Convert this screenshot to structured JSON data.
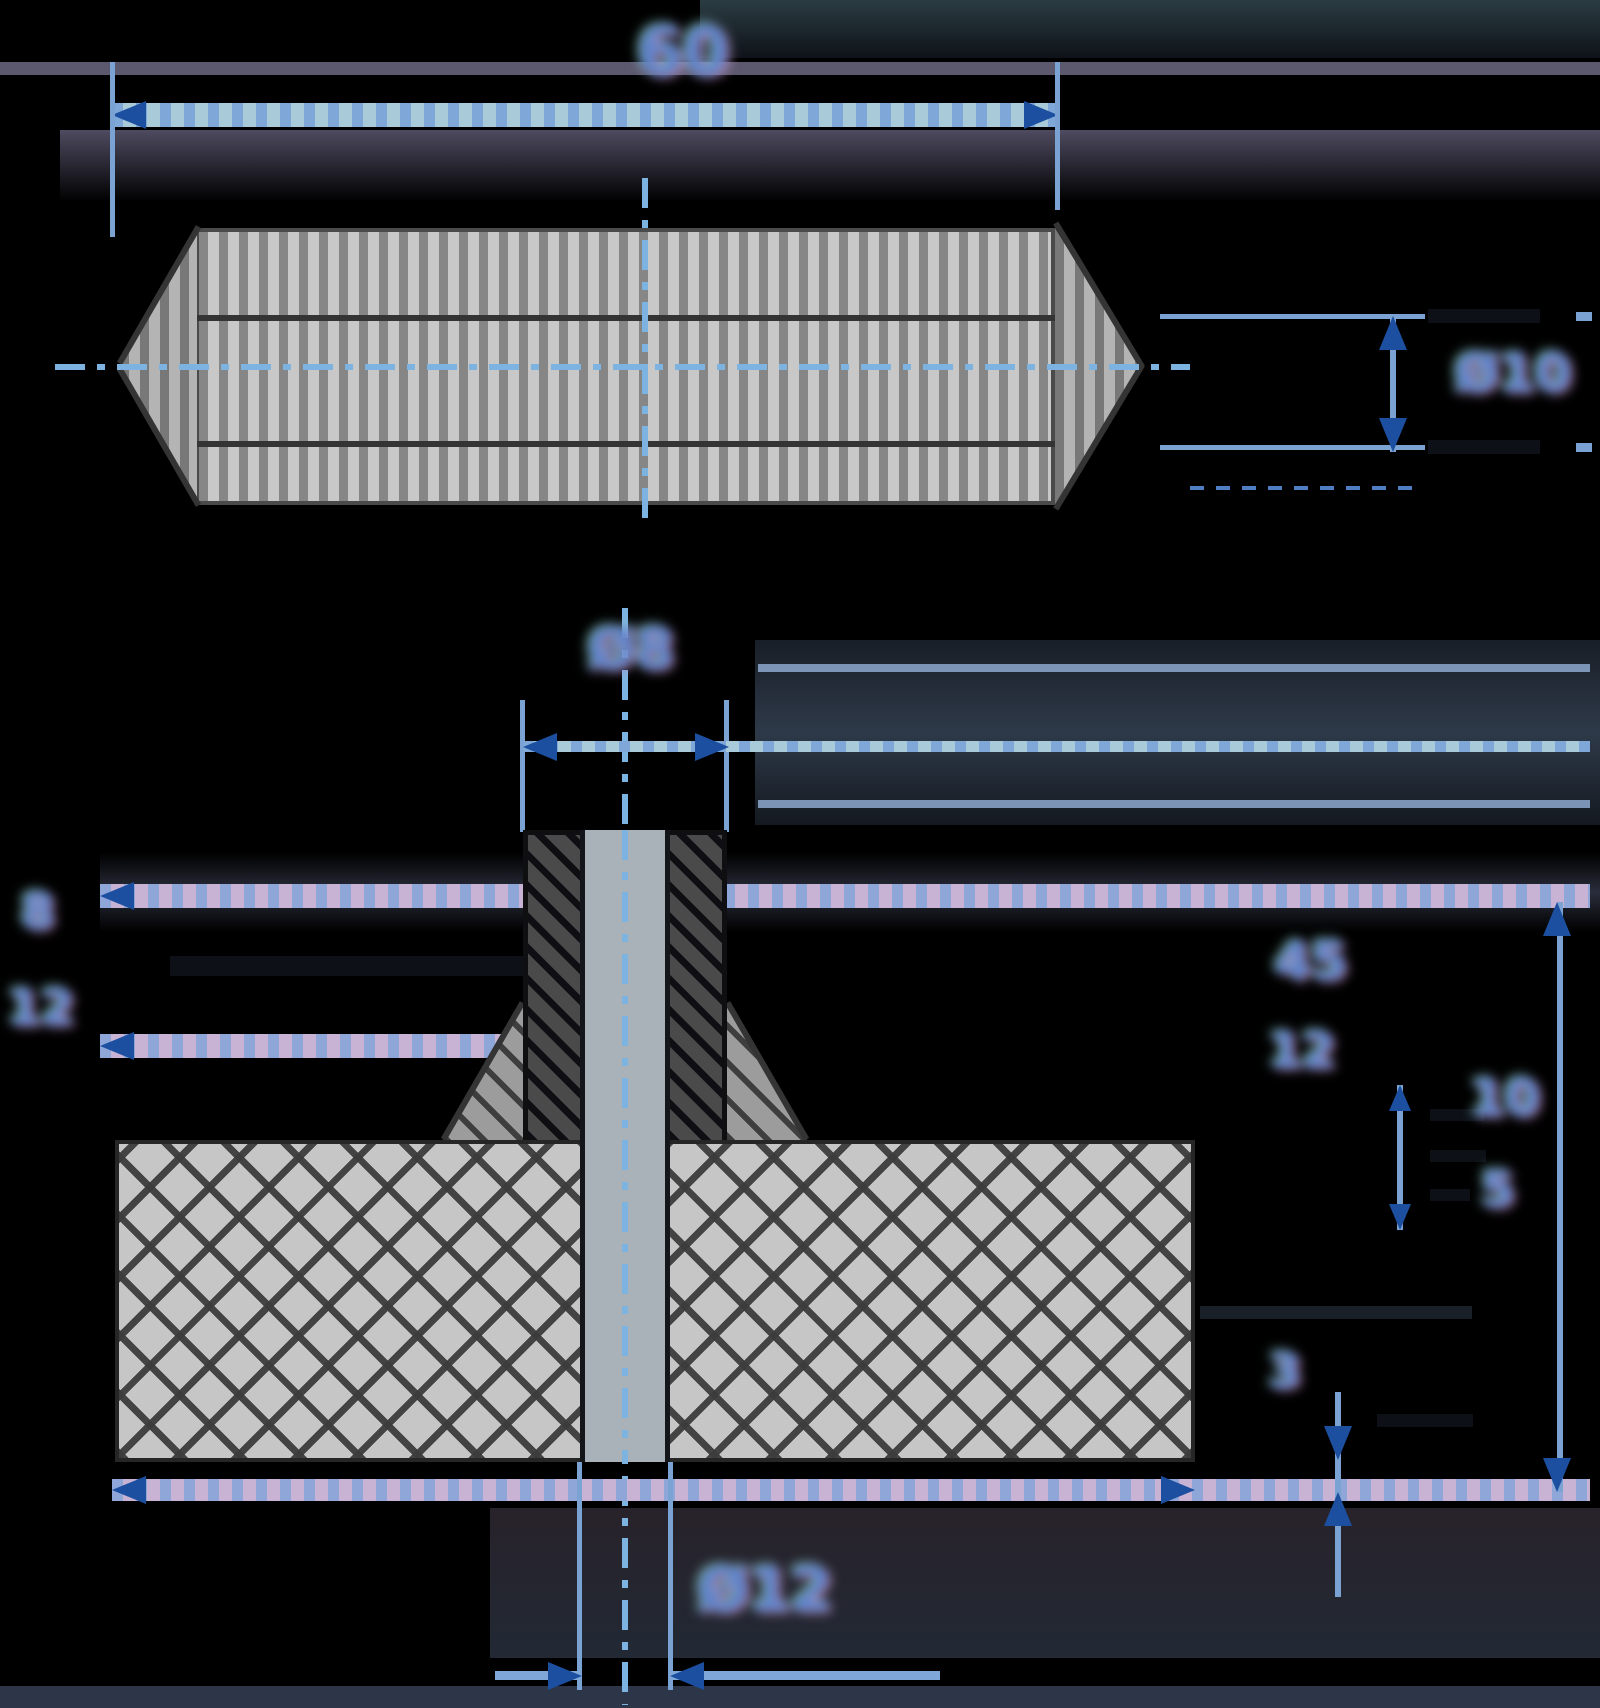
{
  "drawing": {
    "kind": "technical-drawing",
    "background": "#000000",
    "views": {
      "top_view_name": "pin-side-view",
      "bottom_view_name": "flanged-section-view"
    }
  },
  "colors": {
    "background": "#000000",
    "dimension_line": "#7fa8d8",
    "dimension_line_light": "#a9cbd9",
    "dimension_line_pink": "#c9b3d4",
    "arrow": "#1c4f9f",
    "centerline": "#7db3e0",
    "extension_black": "#0d1117",
    "hatch_light": "#c8c8c8",
    "hatch_mid": "#868686",
    "hatch_dark": "#4a4a4a",
    "outline": "#343434",
    "bore_fill": "#a9b1b9",
    "text": "#5b82cb"
  },
  "top_view": {
    "length_label": "60",
    "diameter_label": "Ø10"
  },
  "bottom_view": {
    "stem_diameter_label": "Ø8",
    "left_upper_label": "8",
    "left_lower_label": "12",
    "right_upper_label": "45",
    "right_upper_secondary_label": "12",
    "right_mid_label": "10",
    "right_mid_secondary_label": "5",
    "right_lower_label": "3",
    "bore_diameter_label": "Ø12"
  }
}
